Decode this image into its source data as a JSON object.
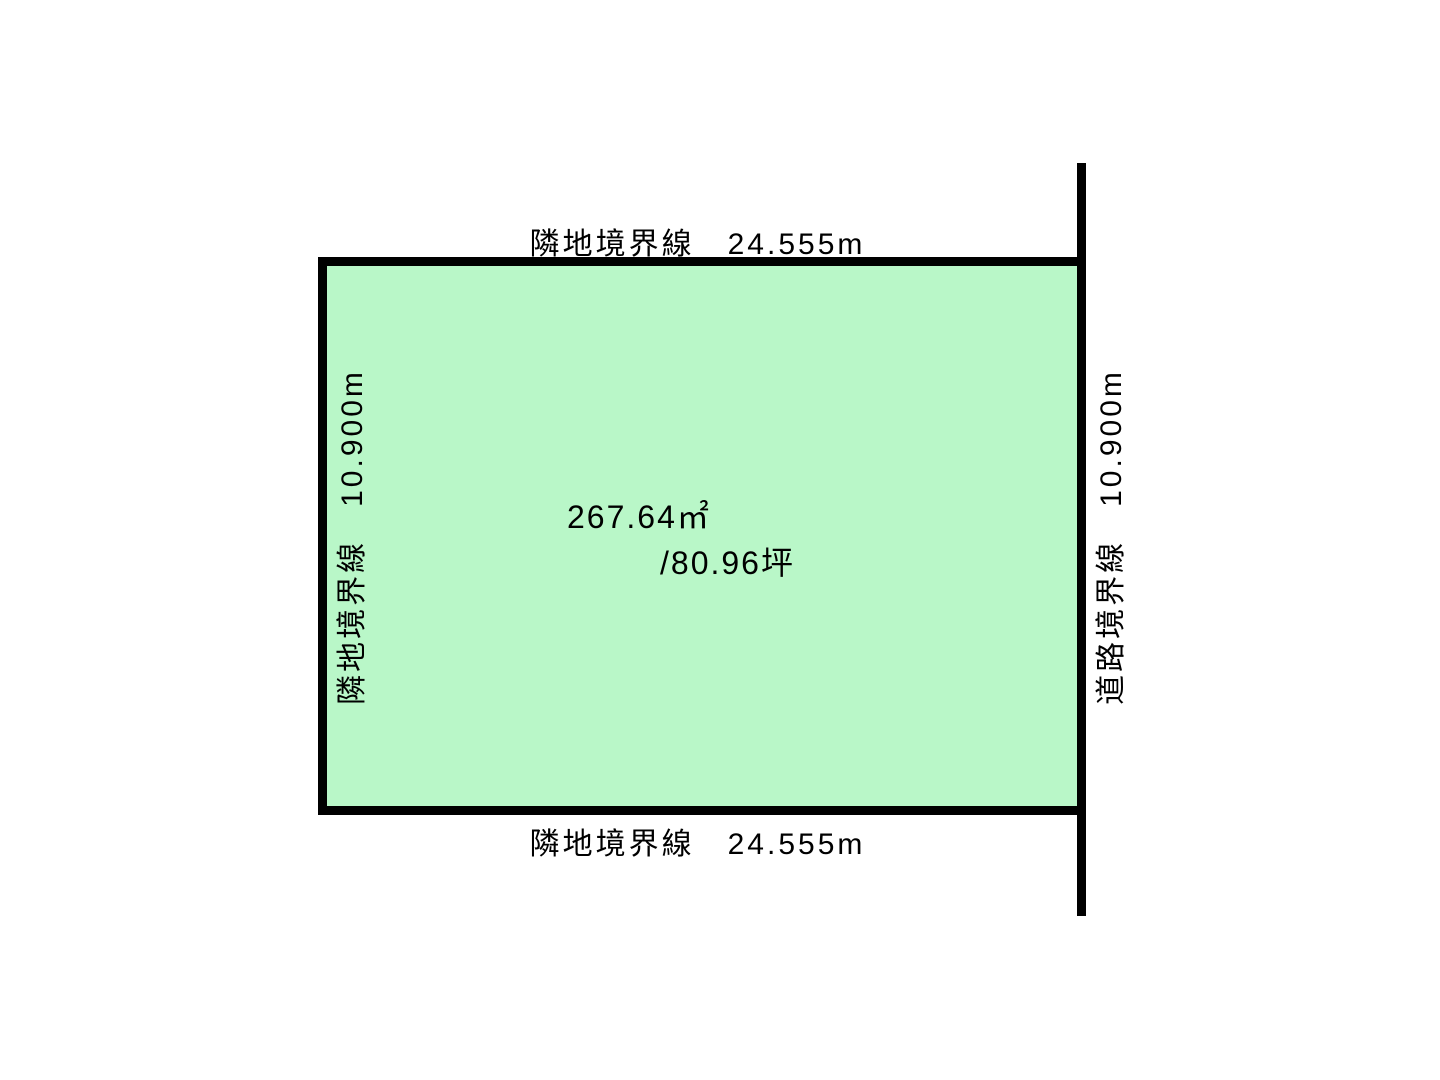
{
  "colors": {
    "plot_fill": "#b9f7c8",
    "boundary_line": "#000000",
    "background": "#ffffff"
  },
  "boundaries": {
    "top": {
      "name": "隣地境界線",
      "length": "24.555m",
      "text": "隣地境界線　24.555m"
    },
    "bottom": {
      "name": "隣地境界線",
      "length": "24.555m",
      "text": "隣地境界線　24.555m"
    },
    "left": {
      "name": "隣地境界線",
      "length": "10.900m",
      "text": "隣地境界線　10.900m"
    },
    "right": {
      "name": "道路境界線",
      "length": "10.900m",
      "text": "道路境界線　10.900m"
    }
  },
  "plot": {
    "area_m2": "267.64㎡",
    "area_tsubo": "/80.96坪"
  }
}
